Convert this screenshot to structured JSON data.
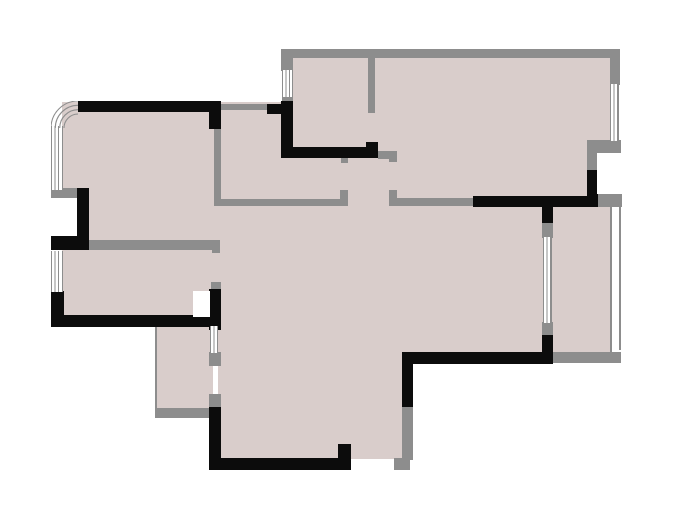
{
  "meta": {
    "description": "Architectural apartment floor plan, no text labels visible",
    "canvas": {
      "width": 684,
      "height": 514,
      "background": "#ffffff"
    }
  },
  "palette": {
    "floor_fill": "#d9cdcb",
    "structural_wall": "#0c0c0c",
    "partition_wall": "#8d8d8d",
    "window_line": "#8d8d8d",
    "opening": "#ffffff"
  },
  "plan": {
    "floor_areas": [
      [
        88,
        102,
        133,
        148
      ],
      [
        62,
        102,
        28,
        88
      ],
      [
        62,
        248,
        159,
        70
      ],
      [
        293,
        55,
        319,
        145
      ],
      [
        218,
        102,
        77,
        108
      ],
      [
        218,
        200,
        393,
        154
      ],
      [
        218,
        200,
        188,
        262
      ],
      [
        156,
        320,
        57,
        92
      ]
    ],
    "walls_gray": [
      [
        281,
        49,
        339,
        9
      ],
      [
        281,
        49,
        12,
        22
      ],
      [
        282,
        96,
        11,
        8
      ],
      [
        610,
        49,
        10,
        36
      ],
      [
        587,
        140,
        34,
        13
      ],
      [
        587,
        153,
        10,
        17
      ],
      [
        596,
        194,
        26,
        13
      ],
      [
        368,
        58,
        7,
        55
      ],
      [
        378,
        151,
        19,
        8
      ],
      [
        389,
        151,
        8,
        11
      ],
      [
        341,
        157,
        7,
        6
      ],
      [
        214,
        199,
        127,
        7
      ],
      [
        340,
        190,
        8,
        16
      ],
      [
        389,
        190,
        8,
        16
      ],
      [
        396,
        198,
        78,
        8
      ],
      [
        214,
        128,
        7,
        72
      ],
      [
        221,
        104,
        47,
        6
      ],
      [
        88,
        240,
        125,
        10
      ],
      [
        212,
        240,
        8,
        13
      ],
      [
        211,
        282,
        10,
        8
      ],
      [
        209,
        352,
        12,
        14
      ],
      [
        155,
        408,
        58,
        10
      ],
      [
        209,
        394,
        12,
        14
      ],
      [
        542,
        222,
        11,
        16
      ],
      [
        542,
        322,
        11,
        14
      ],
      [
        552,
        352,
        69,
        11
      ],
      [
        402,
        407,
        11,
        53
      ],
      [
        394,
        458,
        16,
        12
      ],
      [
        51,
        188,
        26,
        10
      ],
      [
        155,
        322,
        2,
        90
      ],
      [
        610,
        205,
        2,
        147
      ],
      [
        619,
        207,
        2,
        143
      ]
    ],
    "walls_black": [
      [
        78,
        101,
        143,
        11
      ],
      [
        209,
        112,
        12,
        17
      ],
      [
        267,
        104,
        26,
        10
      ],
      [
        281,
        101,
        12,
        57
      ],
      [
        281,
        147,
        85,
        11
      ],
      [
        366,
        142,
        12,
        16
      ],
      [
        473,
        196,
        125,
        11
      ],
      [
        542,
        207,
        11,
        16
      ],
      [
        587,
        170,
        11,
        36
      ],
      [
        542,
        335,
        11,
        28
      ],
      [
        402,
        352,
        151,
        12
      ],
      [
        402,
        352,
        11,
        55
      ],
      [
        209,
        458,
        142,
        12
      ],
      [
        209,
        407,
        12,
        63
      ],
      [
        338,
        444,
        13,
        14
      ],
      [
        77,
        188,
        12,
        62
      ],
      [
        51,
        236,
        38,
        14
      ],
      [
        51,
        291,
        13,
        36
      ],
      [
        51,
        315,
        169,
        12
      ],
      [
        209,
        289,
        12,
        41
      ]
    ],
    "openings_white": [
      [
        597,
        153,
        21,
        41
      ],
      [
        193,
        291,
        17,
        26
      ],
      [
        351,
        459,
        43,
        11
      ]
    ],
    "windows": [
      [
        51,
        126,
        12,
        64
      ],
      [
        282,
        70,
        11,
        27
      ],
      [
        610,
        84,
        9,
        57
      ],
      [
        51,
        251,
        12,
        41
      ],
      [
        210,
        326,
        8,
        27
      ],
      [
        543,
        237,
        9,
        86
      ]
    ],
    "arc_window": {
      "x": 51,
      "y": 101,
      "size": 27,
      "radii": [
        27,
        22.7,
        18.3,
        14
      ]
    }
  }
}
